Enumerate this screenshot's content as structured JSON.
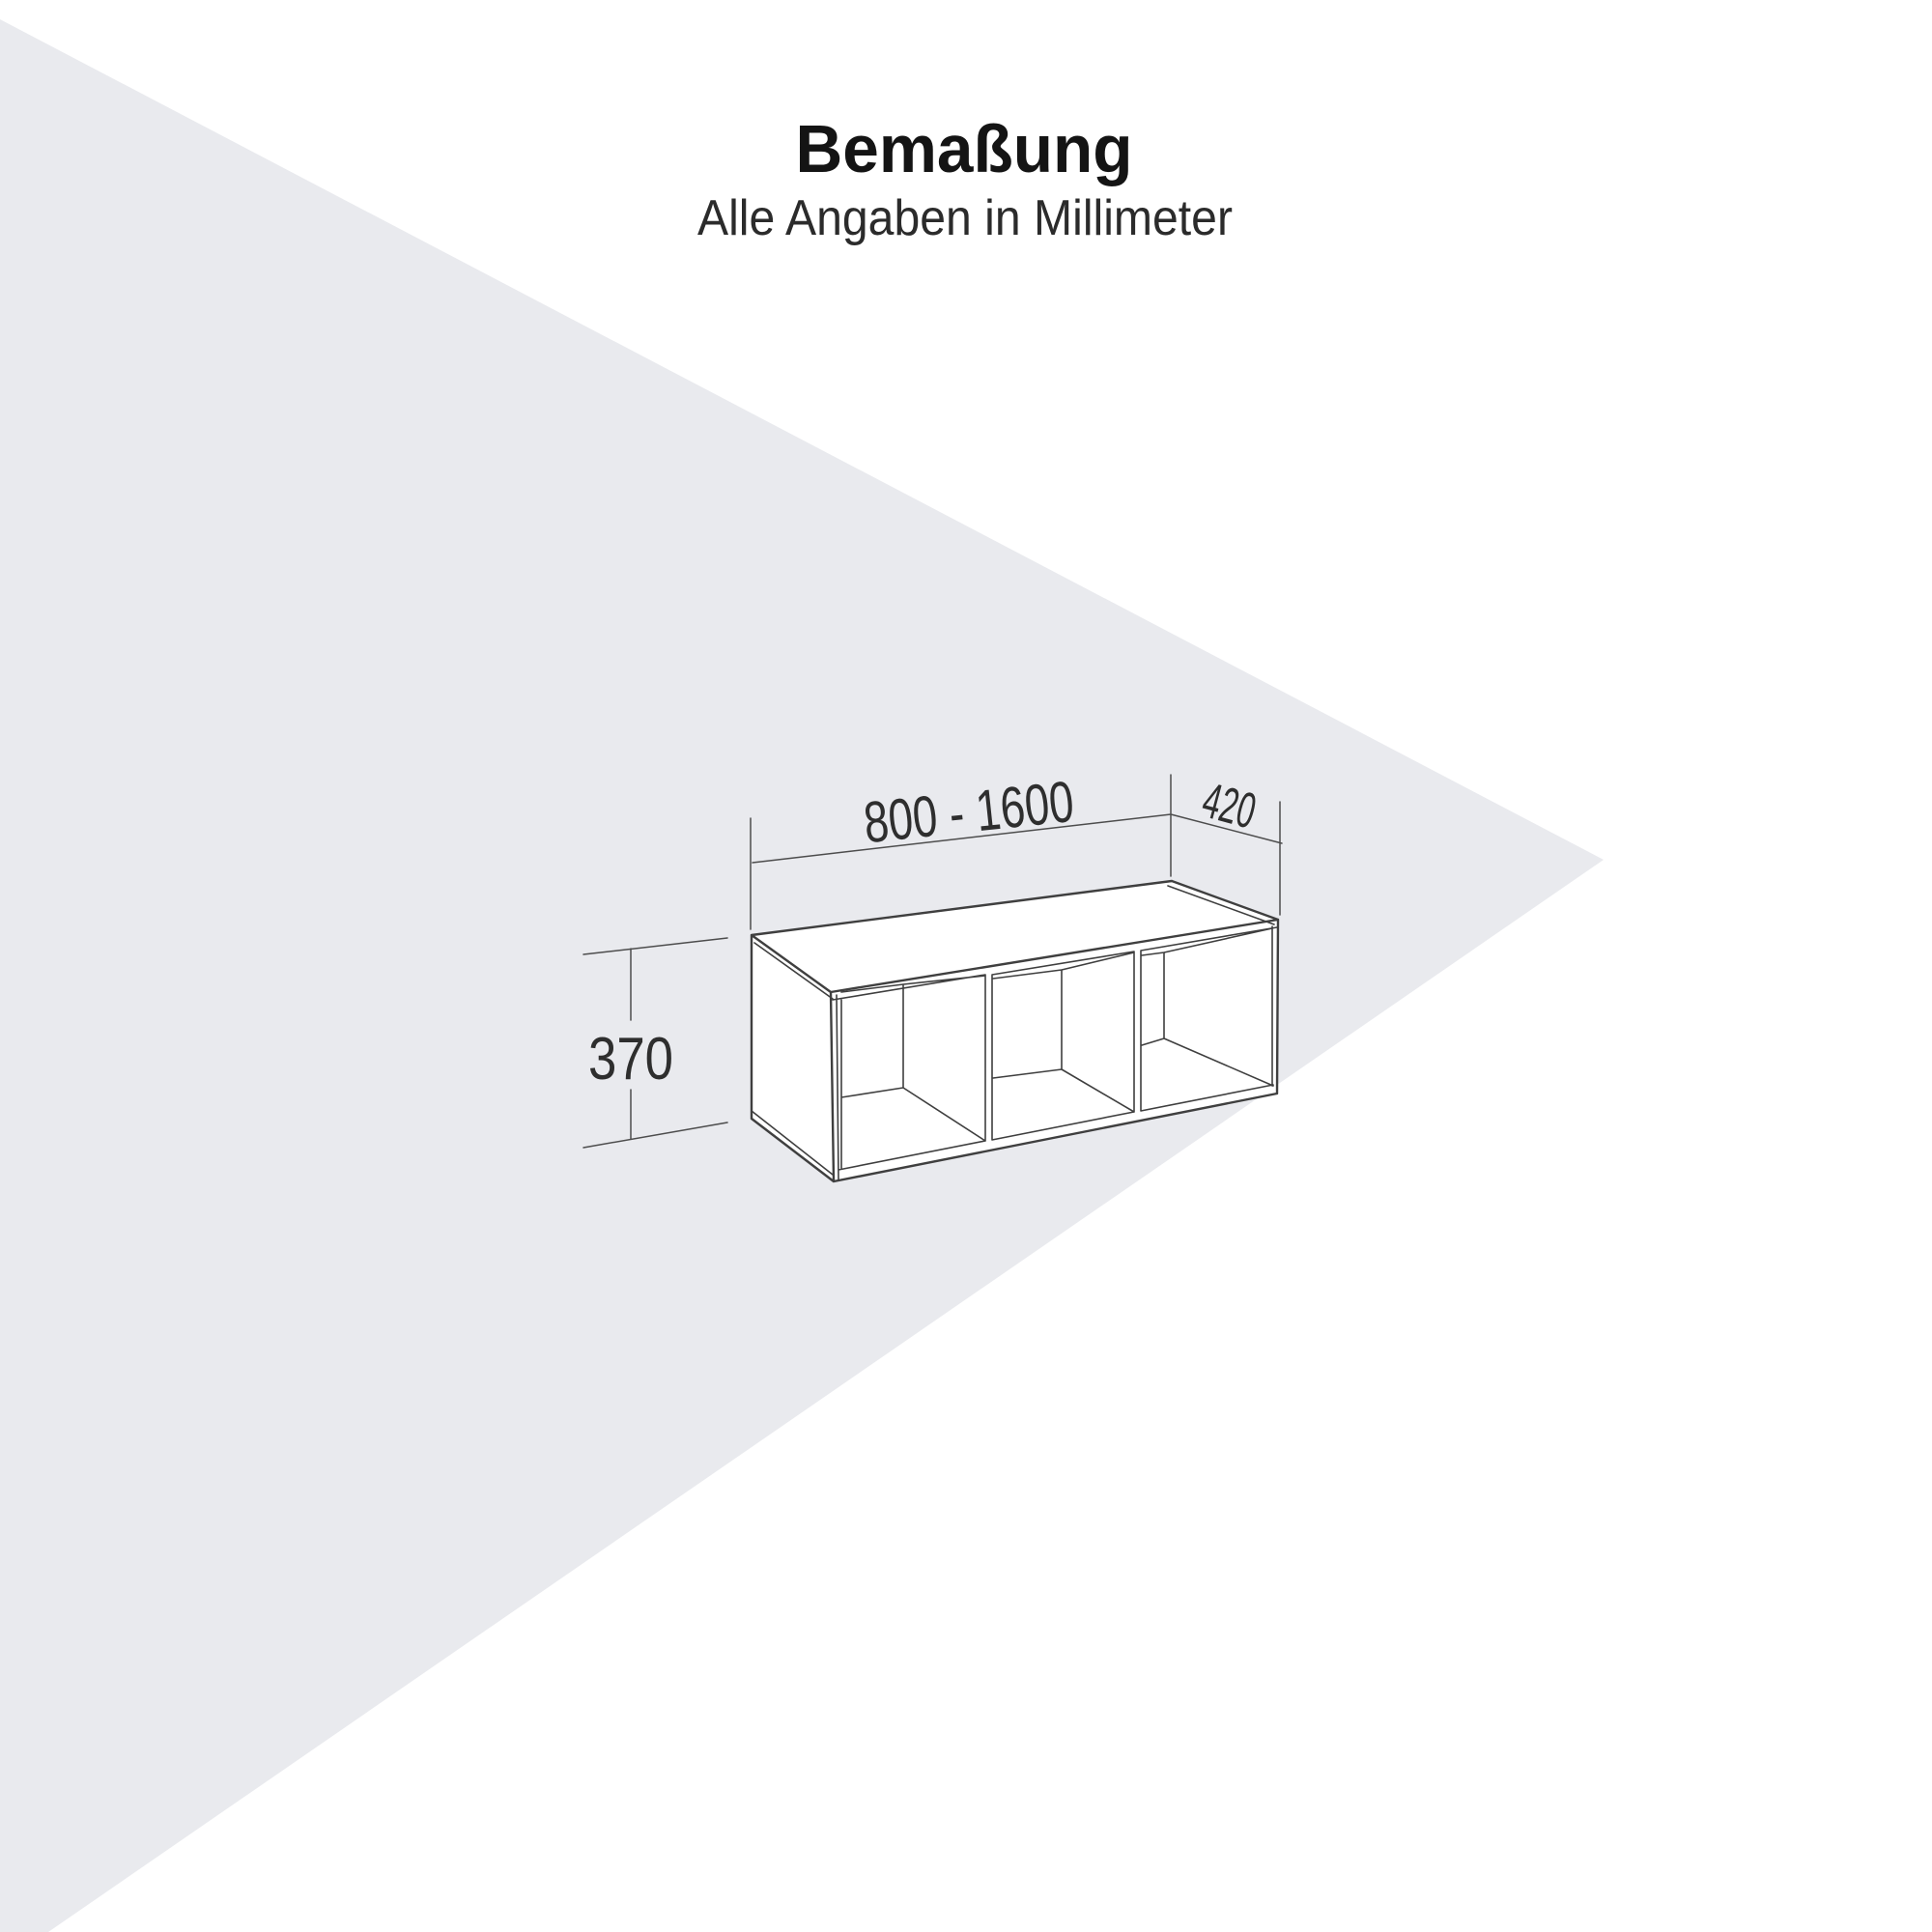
{
  "page": {
    "title": "Bemaßung",
    "subtitle": "Alle Angaben in Millimeter"
  },
  "diagram": {
    "dimensions": {
      "width": "800 - 1600",
      "depth": "420",
      "height": "370"
    }
  },
  "colors": {
    "backdrop_wedge": "#e9eaee",
    "drawing_line": "#3f3f3f",
    "dimension_line": "#4d4d4d",
    "title_text": "#141414",
    "subtitle_text": "#2b2b2b",
    "dimension_text": "#2e2e2e"
  }
}
